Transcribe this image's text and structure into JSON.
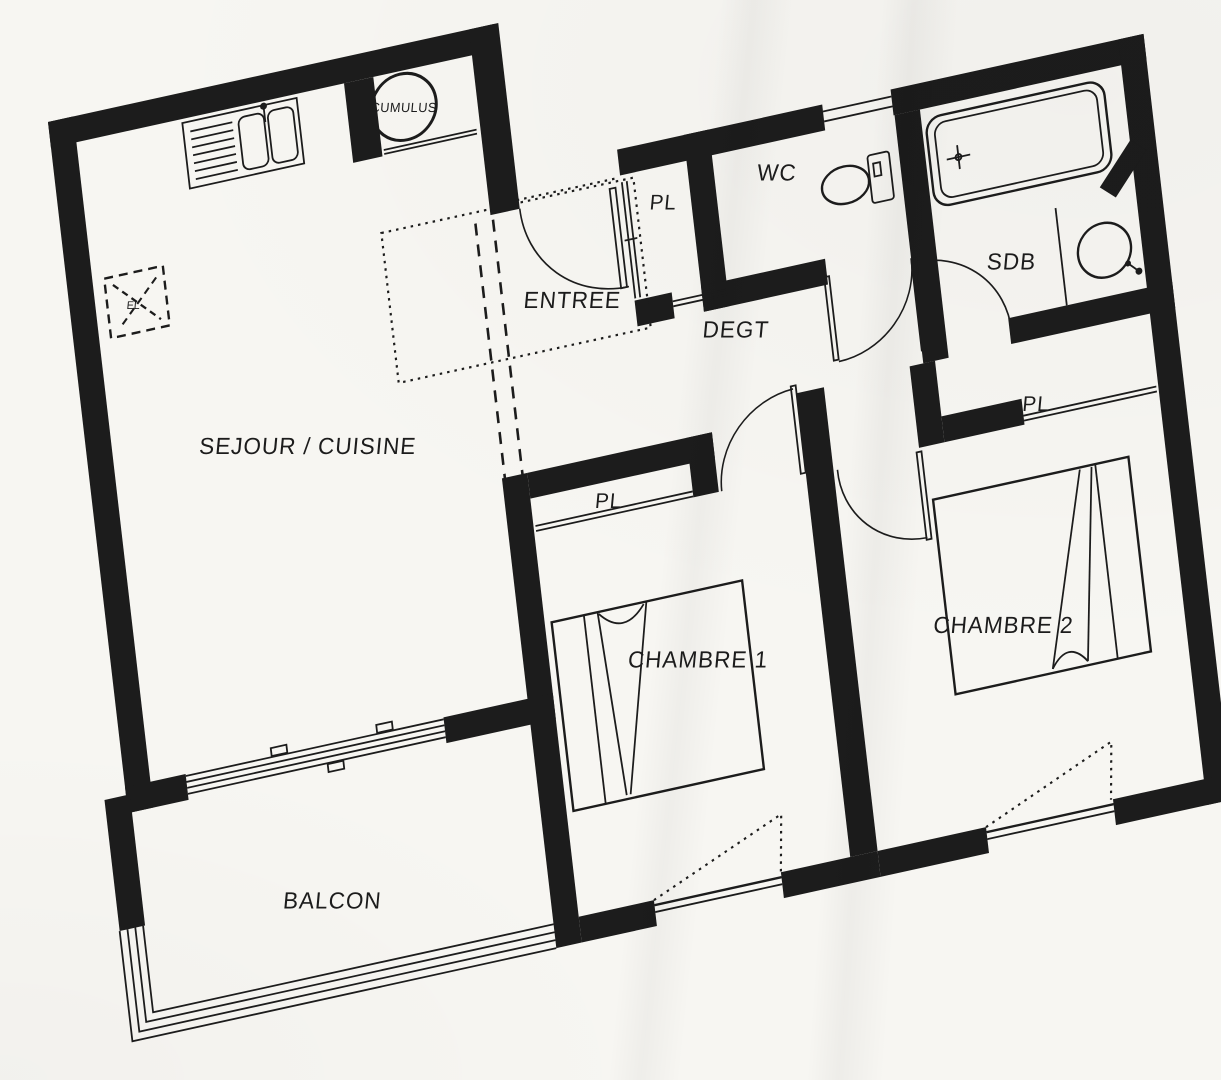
{
  "page": {
    "title": "Plan d'appartement (scan)",
    "colors": {
      "ink": "#1c1c1c",
      "paper": "#f7f6f2"
    }
  },
  "rooms": {
    "sejour_cuisine": {
      "label": "SEJOUR / CUISINE"
    },
    "entree": {
      "label": "ENTREE"
    },
    "degagement": {
      "label": "DEGT"
    },
    "wc": {
      "label": "WC"
    },
    "salle_de_bain": {
      "label": "SDB"
    },
    "chambre1": {
      "label": "CHAMBRE 1"
    },
    "chambre2": {
      "label": "CHAMBRE 2"
    },
    "balcon": {
      "label": "BALCON"
    },
    "placard_entree": {
      "label": "PL"
    },
    "placard_chambre1": {
      "label": "PL"
    },
    "placard_chambre2": {
      "label": "PL"
    },
    "chauffe_eau": {
      "label": "CUMULUS"
    },
    "tableau_electrique": {
      "label": "EL"
    }
  }
}
